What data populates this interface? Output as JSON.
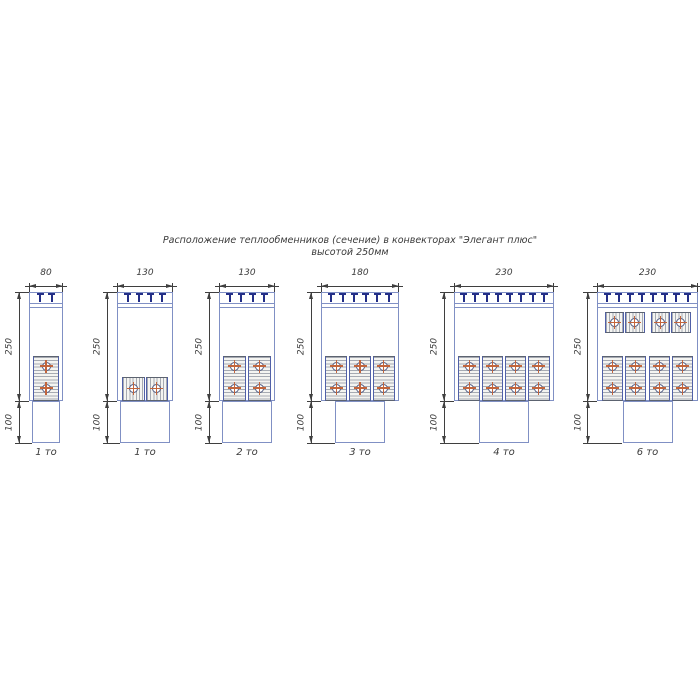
{
  "title": {
    "line1": "Расположение теплообменников (сечение) в конвекторах \"Элегант плюс\"",
    "line2": "высотой 250мм"
  },
  "colors": {
    "line_blue": "#8090c4",
    "grille_navy": "#232e87",
    "hatch_gray": "#a6aab2",
    "cell_dark_edge": "#5c6370",
    "cell_blue_edge": "#5060a8",
    "tube_ring": "#4d5880",
    "tube_cross": "#c2653c",
    "dimension_gray": "#3f3f3f",
    "text_gray": "#3a3a3a"
  },
  "diagrams": [
    {
      "width_mm": 80,
      "width_label": "80",
      "height_label": "250",
      "base_height_label": "100",
      "caption": "1 то",
      "grille_slats": 2,
      "exchangers": {
        "lower": {
          "orientation": "vertical",
          "columns": 1,
          "tubes_per_column": 2
        }
      }
    },
    {
      "width_mm": 130,
      "width_label": "130",
      "height_label": "250",
      "base_height_label": "100",
      "caption": "1 то",
      "grille_slats": 4,
      "exchangers": {
        "lower": {
          "orientation": "horizontal",
          "cells": 2,
          "tubes_per_cell": 1
        }
      }
    },
    {
      "width_mm": 130,
      "width_label": "130",
      "height_label": "250",
      "base_height_label": "100",
      "caption": "2 то",
      "grille_slats": 4,
      "exchangers": {
        "lower": {
          "orientation": "vertical",
          "columns": 2,
          "tubes_per_column": 2
        }
      }
    },
    {
      "width_mm": 180,
      "width_label": "180",
      "height_label": "250",
      "base_height_label": "100",
      "caption": "3 то",
      "grille_slats": 6,
      "exchangers": {
        "lower": {
          "orientation": "vertical",
          "columns": 3,
          "tubes_per_column": 2
        }
      }
    },
    {
      "width_mm": 230,
      "width_label": "230",
      "height_label": "250",
      "base_height_label": "100",
      "caption": "4 то",
      "grille_slats": 8,
      "exchangers": {
        "lower": {
          "orientation": "vertical",
          "columns": 4,
          "tubes_per_column": 2
        }
      }
    },
    {
      "width_mm": 230,
      "width_label": "230",
      "height_label": "250",
      "base_height_label": "100",
      "caption": "6 то",
      "grille_slats": 8,
      "exchangers": {
        "upper": {
          "orientation": "horizontal",
          "blocks": 2,
          "cells_per_block": 2,
          "tubes_per_cell": 1
        },
        "lower": {
          "orientation": "vertical",
          "columns": 4,
          "tubes_per_column": 2
        }
      }
    }
  ]
}
